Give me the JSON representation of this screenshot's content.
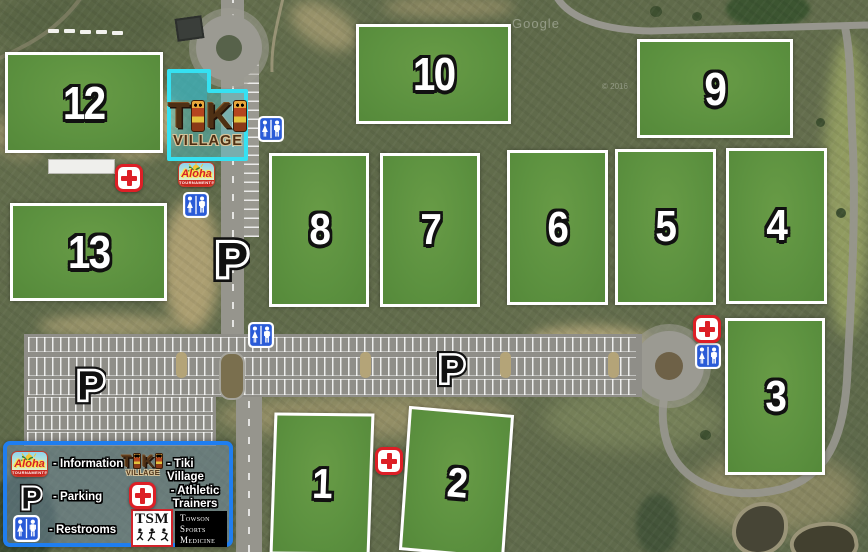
{
  "watermark": {
    "google": "Google",
    "copyright": "© 2016"
  },
  "fields": [
    {
      "label": "12",
      "x": 5,
      "y": 52,
      "w": 158,
      "h": 101,
      "fs": 46,
      "skewX": 0,
      "skewY": 0
    },
    {
      "label": "13",
      "x": 10,
      "y": 203,
      "w": 157,
      "h": 98,
      "fs": 46,
      "skewX": 0,
      "skewY": 0
    },
    {
      "label": "10",
      "x": 356,
      "y": 24,
      "w": 155,
      "h": 100,
      "fs": 46,
      "skewX": 0,
      "skewY": 0
    },
    {
      "label": "9",
      "x": 637,
      "y": 39,
      "w": 156,
      "h": 99,
      "fs": 46,
      "skewX": 0,
      "skewY": 0
    },
    {
      "label": "8",
      "x": 269,
      "y": 153,
      "w": 100,
      "h": 154,
      "fs": 44,
      "skewX": 0,
      "skewY": 0
    },
    {
      "label": "7",
      "x": 380,
      "y": 153,
      "w": 100,
      "h": 154,
      "fs": 44,
      "skewX": 0,
      "skewY": 0
    },
    {
      "label": "6",
      "x": 507,
      "y": 150,
      "w": 101,
      "h": 155,
      "fs": 44,
      "skewX": 0,
      "skewY": 0
    },
    {
      "label": "5",
      "x": 615,
      "y": 149,
      "w": 101,
      "h": 156,
      "fs": 44,
      "skewX": 0,
      "skewY": 0
    },
    {
      "label": "4",
      "x": 726,
      "y": 148,
      "w": 101,
      "h": 156,
      "fs": 44,
      "skewX": 0,
      "skewY": 0
    },
    {
      "label": "3",
      "x": 725,
      "y": 318,
      "w": 100,
      "h": 157,
      "fs": 44,
      "skewX": 0,
      "skewY": 0
    },
    {
      "label": "1",
      "x": 272,
      "y": 413,
      "w": 100,
      "h": 142,
      "fs": 42,
      "skewX": -2,
      "skewY": 0.6
    },
    {
      "label": "2",
      "x": 404,
      "y": 410,
      "w": 105,
      "h": 145,
      "fs": 42,
      "skewX": -4,
      "skewY": 5
    }
  ],
  "parking_letter": "P",
  "parking_icons": [
    {
      "x": 212,
      "y": 231,
      "w": 38,
      "h": 54
    },
    {
      "x": 74,
      "y": 362,
      "w": 32,
      "h": 45
    },
    {
      "x": 435,
      "y": 347,
      "w": 32,
      "h": 42
    }
  ],
  "restroom_icons": [
    {
      "x": 258,
      "y": 116
    },
    {
      "x": 183,
      "y": 192
    },
    {
      "x": 248,
      "y": 322
    },
    {
      "x": 695,
      "y": 343
    }
  ],
  "medical_icons": [
    {
      "x": 115,
      "y": 164
    },
    {
      "x": 693,
      "y": 315
    },
    {
      "x": 375,
      "y": 447
    }
  ],
  "tiki_village": {
    "letter1": "T",
    "letter2": "K",
    "word": "VILLAGE",
    "highlight_color": "#35e1f2"
  },
  "aloha": {
    "name": "Aloha",
    "banner": "TOURNAMENTS"
  },
  "legend": {
    "information_label": "- Information",
    "tiki_label": "- Tiki Village",
    "parking_label": "- Parking",
    "athletic_line1": "- Athletic",
    "athletic_line2": "Trainers",
    "restrooms_label": "- Restrooms",
    "tsm_abbr": "TSM",
    "towson_line1": "Towson",
    "towson_line2": "Sports",
    "towson_line3": "Medicine"
  },
  "colors": {
    "field_green": "#5d9240",
    "legend_border": "#1f7ef0",
    "cyan_highlight": "#35e1f2",
    "cross_red": "#dd1f26",
    "restroom_blue": "#2a5bd7"
  }
}
